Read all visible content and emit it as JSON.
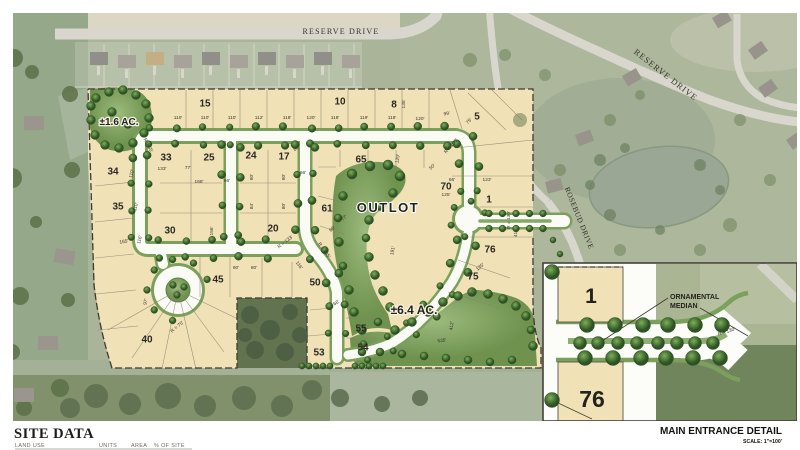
{
  "streets": {
    "reserve_top": "RESERVE DRIVE",
    "reserve_right": "RESERVE DRIVE",
    "rosebud": "ROSEBUD DRIVE"
  },
  "plan": {
    "outlot": "OUTLOT",
    "acreage_small": "±1.6 AC.",
    "acreage_large": "±6.4 AC.",
    "lots": [
      {
        "n": "15",
        "x": 205,
        "y": 103
      },
      {
        "n": "10",
        "x": 340,
        "y": 101
      },
      {
        "n": "8",
        "x": 394,
        "y": 104
      },
      {
        "n": "5",
        "x": 477,
        "y": 116
      },
      {
        "n": "33",
        "x": 166,
        "y": 157
      },
      {
        "n": "25",
        "x": 209,
        "y": 157
      },
      {
        "n": "24",
        "x": 251,
        "y": 155
      },
      {
        "n": "17",
        "x": 284,
        "y": 156
      },
      {
        "n": "65",
        "x": 361,
        "y": 159
      },
      {
        "n": "34",
        "x": 113,
        "y": 171
      },
      {
        "n": "35",
        "x": 118,
        "y": 206
      },
      {
        "n": "30",
        "x": 170,
        "y": 230
      },
      {
        "n": "20",
        "x": 273,
        "y": 228
      },
      {
        "n": "61",
        "x": 327,
        "y": 208
      },
      {
        "n": "70",
        "x": 446,
        "y": 186
      },
      {
        "n": "1",
        "x": 489,
        "y": 199
      },
      {
        "n": "45",
        "x": 218,
        "y": 279
      },
      {
        "n": "50",
        "x": 315,
        "y": 282
      },
      {
        "n": "76",
        "x": 490,
        "y": 249
      },
      {
        "n": "75",
        "x": 473,
        "y": 276
      },
      {
        "n": "40",
        "x": 147,
        "y": 339
      },
      {
        "n": "55",
        "x": 361,
        "y": 328
      },
      {
        "n": "54",
        "x": 363,
        "y": 347
      },
      {
        "n": "53",
        "x": 319,
        "y": 352
      }
    ],
    "dims": [
      {
        "t": "110'",
        "x": 178,
        "y": 119,
        "r": 0
      },
      {
        "t": "110'",
        "x": 205,
        "y": 119,
        "r": 0
      },
      {
        "t": "110'",
        "x": 232,
        "y": 119,
        "r": 0
      },
      {
        "t": "112'",
        "x": 259,
        "y": 119,
        "r": 0
      },
      {
        "t": "118'",
        "x": 287,
        "y": 119,
        "r": 0
      },
      {
        "t": "120'",
        "x": 311,
        "y": 119,
        "r": 0
      },
      {
        "t": "118'",
        "x": 335,
        "y": 119,
        "r": 0
      },
      {
        "t": "119'",
        "x": 364,
        "y": 119,
        "r": 0
      },
      {
        "t": "118'",
        "x": 392,
        "y": 119,
        "r": 0
      },
      {
        "t": "120'",
        "x": 420,
        "y": 120,
        "r": 0
      },
      {
        "t": "99'",
        "x": 447,
        "y": 115,
        "r": -10
      },
      {
        "t": "75'",
        "x": 470,
        "y": 122,
        "r": -45
      },
      {
        "t": "135'",
        "x": 405,
        "y": 104,
        "r": -90
      },
      {
        "t": "R = 100'",
        "x": 452,
        "y": 147,
        "r": -48
      },
      {
        "t": "R = 55'",
        "x": 147,
        "y": 146,
        "r": 62
      },
      {
        "t": "133'",
        "x": 162,
        "y": 170,
        "r": 0
      },
      {
        "t": "77'",
        "x": 188,
        "y": 169,
        "r": 0
      },
      {
        "t": "168'",
        "x": 199,
        "y": 183,
        "r": 0
      },
      {
        "t": "66'",
        "x": 227,
        "y": 182,
        "r": 0
      },
      {
        "t": "156'",
        "x": 213,
        "y": 231,
        "r": -90
      },
      {
        "t": "165'",
        "x": 124,
        "y": 243,
        "r": -8
      },
      {
        "t": "110'",
        "x": 133,
        "y": 174,
        "r": -76
      },
      {
        "t": "110'",
        "x": 137,
        "y": 207,
        "r": -76
      },
      {
        "t": "116'",
        "x": 141,
        "y": 240,
        "r": -76
      },
      {
        "t": "97'",
        "x": 147,
        "y": 302,
        "r": -80
      },
      {
        "t": "80'",
        "x": 253,
        "y": 177,
        "r": -90
      },
      {
        "t": "80'",
        "x": 285,
        "y": 177,
        "r": -90
      },
      {
        "t": "84'",
        "x": 253,
        "y": 206,
        "r": -90
      },
      {
        "t": "80'",
        "x": 285,
        "y": 206,
        "r": -90
      },
      {
        "t": "64'",
        "x": 297,
        "y": 150,
        "r": -20
      },
      {
        "t": "R = 133'",
        "x": 286,
        "y": 243,
        "r": -38
      },
      {
        "t": "R = 135'",
        "x": 323,
        "y": 251,
        "r": 55
      },
      {
        "t": "116'",
        "x": 298,
        "y": 266,
        "r": 55
      },
      {
        "t": "80'",
        "x": 236,
        "y": 269,
        "r": 0
      },
      {
        "t": "80'",
        "x": 254,
        "y": 269,
        "r": 0
      },
      {
        "t": "66'",
        "x": 303,
        "y": 174,
        "r": 0
      },
      {
        "t": "66'",
        "x": 337,
        "y": 304,
        "r": -30
      },
      {
        "t": "96'",
        "x": 333,
        "y": 230,
        "r": -40
      },
      {
        "t": "77'",
        "x": 345,
        "y": 219,
        "r": -40
      },
      {
        "t": "129'",
        "x": 399,
        "y": 159,
        "r": -80
      },
      {
        "t": "50'",
        "x": 433,
        "y": 168,
        "r": -40
      },
      {
        "t": "66'",
        "x": 452,
        "y": 181,
        "r": 0
      },
      {
        "t": "123'",
        "x": 487,
        "y": 181,
        "r": 0
      },
      {
        "t": "125'",
        "x": 446,
        "y": 196,
        "r": 0
      },
      {
        "t": "R = 130'",
        "x": 510,
        "y": 220,
        "r": -90
      },
      {
        "t": "41'",
        "x": 517,
        "y": 234,
        "r": -90
      },
      {
        "t": "135'",
        "x": 481,
        "y": 268,
        "r": -40
      },
      {
        "t": "27'",
        "x": 474,
        "y": 293,
        "r": -65
      },
      {
        "t": "191'",
        "x": 394,
        "y": 251,
        "r": -78
      },
      {
        "t": "412'",
        "x": 453,
        "y": 326,
        "r": -85
      },
      {
        "t": "535'",
        "x": 442,
        "y": 342,
        "r": -5
      },
      {
        "t": "R = 75'",
        "x": 178,
        "y": 328,
        "r": -40
      }
    ]
  },
  "inset": {
    "lot_top": "1",
    "lot_bottom": "76",
    "median_label": [
      "ORNAMENTAL",
      "MEDIAN"
    ],
    "radius": "R = 130'",
    "title": "MAIN ENTRANCE DETAIL",
    "scale": "SCALE: 1\"=100'"
  },
  "site_data": {
    "title": "SITE DATA",
    "columns": [
      "LAND USE",
      "UNITS",
      "AREA",
      "% OF SITE"
    ]
  },
  "colors": {
    "lot_tan": "#f0e1b6",
    "road_white": "#fbfbf6",
    "green_edge": "#7ba05b",
    "tree_dark": "#3f6b32",
    "aerial_green": "#9fac8f",
    "boundary_ink": "#3d3a32"
  }
}
